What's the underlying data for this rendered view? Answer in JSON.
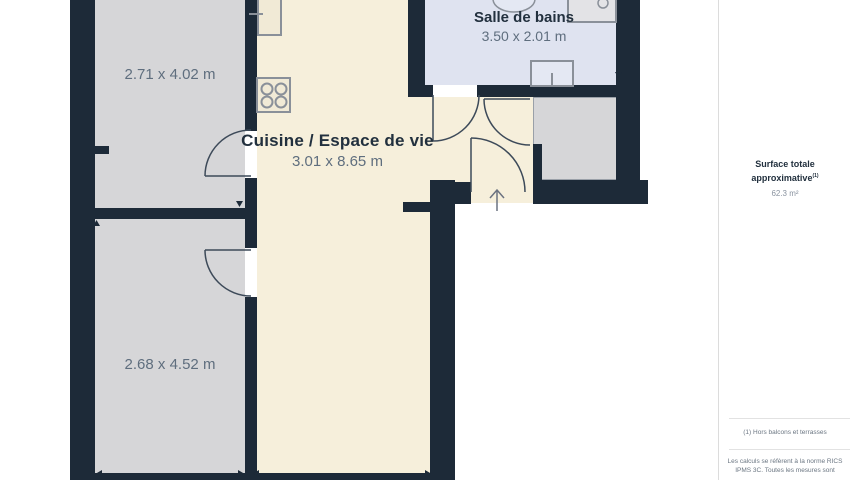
{
  "plan": {
    "rooms": {
      "bedroom_top": {
        "dims": "2.71 x 4.02 m"
      },
      "living": {
        "name": "Cuisine / Espace de vie",
        "dims": "3.01 x 8.65 m"
      },
      "bathroom": {
        "name": "Salle de bains",
        "dims": "3.50 x 2.01 m"
      },
      "bedroom_bottom": {
        "dims": "2.68 x 4.52 m"
      }
    },
    "icons": {
      "entrance_arrow": "up-arrow entrance marker",
      "stove": "4-burner hob",
      "kitchen_counter": "counter with sink tick",
      "bathroom_sink": "oval wash basin",
      "shower": "shower tray with drain",
      "toilet": "toilet cistern top view",
      "measure_markers": "small dimension arrowheads"
    }
  },
  "sidebar": {
    "surface_label": "Surface totale approximative",
    "surface_note_ref": "(1)",
    "surface_value": "62.3 m²",
    "footnote_1": "(1) Hors balcons et terrasses",
    "footnote_2": "Les calculs se réfèrent à la norme RICS IPMS 3C. Toutes les mesures sont"
  },
  "colors": {
    "wall": "#1d2a38",
    "living_floor": "#f6efdb",
    "room_floor": "#d6d6d8",
    "bathroom_floor": "#dfe3f0",
    "fixture_stroke": "#8a9099",
    "room_name_text": "#22303e",
    "dimension_text": "#5f6e7e",
    "footnote_text": "#6b7682",
    "divider": "#e2e2e2"
  }
}
